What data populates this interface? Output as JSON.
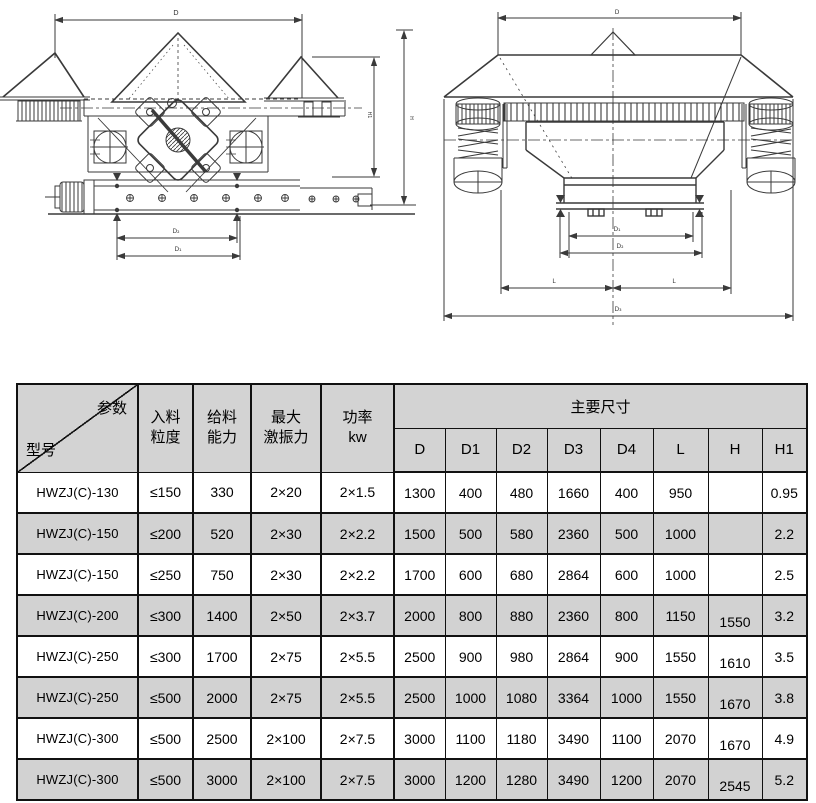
{
  "drawings": {
    "left_view": {
      "dim_labels": {
        "top_width": "D",
        "height_outer": "H",
        "height_inner": "H1",
        "bottom_upper": "D₂",
        "bottom_lower": "D₁"
      }
    },
    "right_view": {
      "dim_labels": {
        "top_width": "D",
        "outlet_inner": "D₁",
        "outlet_outer": "D₂",
        "left_span": "L",
        "right_span": "L",
        "bottom_width": "D₃"
      }
    }
  },
  "table": {
    "corner": {
      "param_label": "参数",
      "model_label": "型号"
    },
    "param_columns": [
      {
        "l1": "入料",
        "l2": "粒度"
      },
      {
        "l1": "给料",
        "l2": "能力"
      },
      {
        "l1": "最大",
        "l2": "激振力"
      },
      {
        "l1": "功率",
        "l2": "kw"
      }
    ],
    "dims_header": "主要尺寸",
    "dim_columns": [
      "D",
      "D1",
      "D2",
      "D3",
      "D4",
      "L",
      "H",
      "H1"
    ],
    "rows": [
      [
        "HWZJ(C)-130",
        "≤150",
        "330",
        "2×20",
        "2×1.5",
        "1300",
        "400",
        "480",
        "1660",
        "400",
        "950",
        "",
        "0.95"
      ],
      [
        "HWZJ(C)-150",
        "≤200",
        "520",
        "2×30",
        "2×2.2",
        "1500",
        "500",
        "580",
        "2360",
        "500",
        "1000",
        "",
        "2.2"
      ],
      [
        "HWZJ(C)-150",
        "≤250",
        "750",
        "2×30",
        "2×2.2",
        "1700",
        "600",
        "680",
        "2864",
        "600",
        "1000",
        "",
        "2.5"
      ],
      [
        "HWZJ(C)-200",
        "≤300",
        "1400",
        "2×50",
        "2×3.7",
        "2000",
        "800",
        "880",
        "2360",
        "800",
        "1150",
        "1550",
        "3.2"
      ],
      [
        "HWZJ(C)-250",
        "≤300",
        "1700",
        "2×75",
        "2×5.5",
        "2500",
        "900",
        "980",
        "2864",
        "900",
        "1550",
        "1610",
        "3.5"
      ],
      [
        "HWZJ(C)-250",
        "≤500",
        "2000",
        "2×75",
        "2×5.5",
        "2500",
        "1000",
        "1080",
        "3364",
        "1000",
        "1550",
        "1670",
        "3.8"
      ],
      [
        "HWZJ(C)-300",
        "≤500",
        "2500",
        "2×100",
        "2×7.5",
        "3000",
        "1100",
        "1180",
        "3490",
        "1100",
        "2070",
        "1670",
        "4.9"
      ],
      [
        "HWZJ(C)-300",
        "≤500",
        "3000",
        "2×100",
        "2×7.5",
        "3000",
        "1200",
        "1280",
        "3490",
        "1200",
        "2070",
        "2545",
        "5.2"
      ]
    ]
  }
}
